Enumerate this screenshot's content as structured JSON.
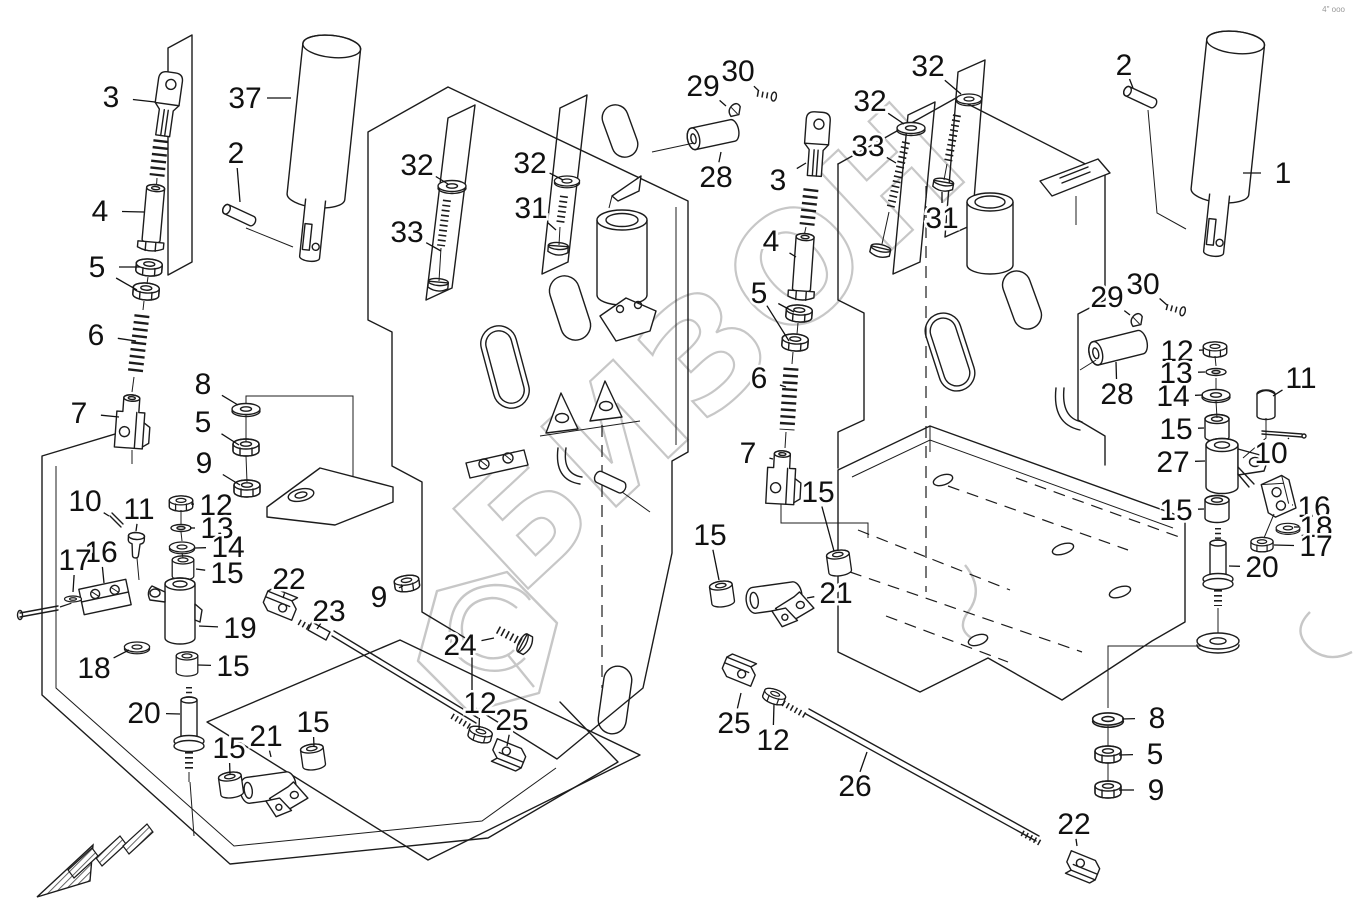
{
  "watermark": {
    "text": "БИЗОН",
    "color": "#c7c7c7",
    "logo": "hexagon-emblem"
  },
  "corner_code": "4\" ooo",
  "icons": {
    "direction_arrow": "hatched-arrow-pointing-lower-left"
  },
  "callouts": [
    {
      "n": "3",
      "x": 111,
      "y": 97,
      "t": [
        [
          155,
          102
        ]
      ]
    },
    {
      "n": "37",
      "x": 245,
      "y": 98,
      "t": [
        [
          291,
          98
        ]
      ]
    },
    {
      "n": "2",
      "x": 236,
      "y": 153,
      "t": [
        [
          240,
          202
        ]
      ]
    },
    {
      "n": "4",
      "x": 100,
      "y": 211,
      "t": [
        [
          144,
          212
        ]
      ]
    },
    {
      "n": "5",
      "x": 97,
      "y": 267,
      "t": [
        [
          140,
          267
        ],
        [
          137,
          290
        ]
      ]
    },
    {
      "n": "32",
      "x": 417,
      "y": 165,
      "t": [
        [
          448,
          184
        ]
      ]
    },
    {
      "n": "33",
      "x": 407,
      "y": 232,
      "t": [
        [
          441,
          251
        ]
      ]
    },
    {
      "n": "32",
      "x": 530,
      "y": 163,
      "t": [
        [
          563,
          180
        ]
      ]
    },
    {
      "n": "31",
      "x": 531,
      "y": 208,
      "t": [
        [
          556,
          230
        ]
      ]
    },
    {
      "n": "6",
      "x": 96,
      "y": 335,
      "t": [
        [
          136,
          341
        ]
      ]
    },
    {
      "n": "7",
      "x": 79,
      "y": 413,
      "t": [
        [
          119,
          417
        ]
      ]
    },
    {
      "n": "8",
      "x": 203,
      "y": 384,
      "t": [
        [
          238,
          405
        ]
      ]
    },
    {
      "n": "5",
      "x": 203,
      "y": 422,
      "t": [
        [
          239,
          445
        ]
      ]
    },
    {
      "n": "9",
      "x": 204,
      "y": 463,
      "t": [
        [
          240,
          485
        ]
      ]
    },
    {
      "n": "10",
      "x": 85,
      "y": 501,
      "t": [
        [
          109,
          516
        ]
      ]
    },
    {
      "n": "11",
      "x": 139,
      "y": 509,
      "t": [
        [
          136,
          531
        ]
      ]
    },
    {
      "n": "12",
      "x": 216,
      "y": 505,
      "t": [
        [
          191,
          504
        ]
      ]
    },
    {
      "n": "13",
      "x": 217,
      "y": 528,
      "t": [
        [
          190,
          528
        ]
      ]
    },
    {
      "n": "14",
      "x": 228,
      "y": 547,
      "t": [
        [
          195,
          548
        ]
      ]
    },
    {
      "n": "15",
      "x": 227,
      "y": 573,
      "t": [
        [
          196,
          569
        ]
      ]
    },
    {
      "n": "16",
      "x": 101,
      "y": 552,
      "t": [
        [
          104,
          583
        ]
      ]
    },
    {
      "n": "17",
      "x": 75,
      "y": 560,
      "t": [
        [
          73,
          592
        ]
      ]
    },
    {
      "n": "19",
      "x": 240,
      "y": 628,
      "t": [
        [
          199,
          626
        ]
      ]
    },
    {
      "n": "18",
      "x": 94,
      "y": 668,
      "t": [
        [
          129,
          650
        ]
      ]
    },
    {
      "n": "15",
      "x": 233,
      "y": 666,
      "t": [
        [
          198,
          665
        ]
      ]
    },
    {
      "n": "20",
      "x": 144,
      "y": 713,
      "t": [
        [
          180,
          714
        ]
      ]
    },
    {
      "n": "15",
      "x": 229,
      "y": 748,
      "t": [
        [
          230,
          774
        ]
      ]
    },
    {
      "n": "21",
      "x": 266,
      "y": 736,
      "t": [
        [
          271,
          757
        ]
      ]
    },
    {
      "n": "15",
      "x": 313,
      "y": 722,
      "t": [
        [
          314,
          747
        ]
      ]
    },
    {
      "n": "22",
      "x": 289,
      "y": 579,
      "t": [
        [
          283,
          598
        ]
      ]
    },
    {
      "n": "23",
      "x": 329,
      "y": 611,
      "t": [
        [
          317,
          629
        ]
      ]
    },
    {
      "n": "9",
      "x": 379,
      "y": 597,
      "t": [
        [
          403,
          586
        ]
      ]
    },
    {
      "n": "24",
      "x": 460,
      "y": 645,
      "t": [
        [
          494,
          638
        ]
      ]
    },
    {
      "n": "12",
      "x": 480,
      "y": 703,
      "t": [
        [
          479,
          730
        ]
      ]
    },
    {
      "n": "25",
      "x": 512,
      "y": 720,
      "t": [
        [
          507,
          746
        ]
      ]
    },
    {
      "n": "29",
      "x": 703,
      "y": 86,
      "t": [
        [
          726,
          106
        ]
      ]
    },
    {
      "n": "30",
      "x": 738,
      "y": 71,
      "t": [
        [
          759,
          91
        ]
      ]
    },
    {
      "n": "28",
      "x": 716,
      "y": 177,
      "t": [
        [
          721,
          152
        ]
      ]
    },
    {
      "n": "3",
      "x": 778,
      "y": 180,
      "t": [
        [
          806,
          163
        ]
      ]
    },
    {
      "n": "4",
      "x": 771,
      "y": 241,
      "t": [
        [
          796,
          257
        ]
      ]
    },
    {
      "n": "5",
      "x": 759,
      "y": 293,
      "t": [
        [
          794,
          312
        ],
        [
          789,
          341
        ]
      ]
    },
    {
      "n": "32",
      "x": 870,
      "y": 101,
      "t": [
        [
          904,
          124
        ]
      ]
    },
    {
      "n": "33",
      "x": 868,
      "y": 146,
      "t": [
        [
          896,
          163
        ]
      ]
    },
    {
      "n": "32",
      "x": 928,
      "y": 66,
      "t": [
        [
          961,
          94
        ]
      ]
    },
    {
      "n": "31",
      "x": 942,
      "y": 218,
      "t": [
        [
          942,
          192
        ]
      ]
    },
    {
      "n": "2",
      "x": 1124,
      "y": 65,
      "t": [
        [
          1133,
          88
        ]
      ]
    },
    {
      "n": "1",
      "x": 1283,
      "y": 173,
      "t": [
        [
          1243,
          173
        ]
      ]
    },
    {
      "n": "29",
      "x": 1107,
      "y": 297,
      "t": [
        [
          1130,
          315
        ]
      ]
    },
    {
      "n": "30",
      "x": 1143,
      "y": 284,
      "t": [
        [
          1167,
          305
        ]
      ]
    },
    {
      "n": "28",
      "x": 1117,
      "y": 394,
      "t": [
        [
          1116,
          362
        ]
      ]
    },
    {
      "n": "12",
      "x": 1177,
      "y": 351,
      "t": [
        [
          1204,
          350
        ]
      ]
    },
    {
      "n": "13",
      "x": 1176,
      "y": 373,
      "t": [
        [
          1205,
          372
        ]
      ]
    },
    {
      "n": "14",
      "x": 1173,
      "y": 396,
      "t": [
        [
          1203,
          395
        ]
      ]
    },
    {
      "n": "15",
      "x": 1176,
      "y": 429,
      "t": [
        [
          1204,
          428
        ]
      ]
    },
    {
      "n": "11",
      "x": 1301,
      "y": 378,
      "t": [
        [
          1273,
          396
        ]
      ]
    },
    {
      "n": "10",
      "x": 1271,
      "y": 453,
      "t": [
        [
          1289,
          438
        ]
      ]
    },
    {
      "n": "27",
      "x": 1173,
      "y": 462,
      "t": [
        [
          1205,
          461
        ]
      ]
    },
    {
      "n": "16",
      "x": 1314,
      "y": 507,
      "t": [
        [
          1293,
          505
        ]
      ]
    },
    {
      "n": "18",
      "x": 1316,
      "y": 527,
      "t": [
        [
          1299,
          527
        ]
      ]
    },
    {
      "n": "17",
      "x": 1316,
      "y": 546,
      "t": [
        [
          1274,
          545
        ]
      ]
    },
    {
      "n": "15",
      "x": 1176,
      "y": 510,
      "t": [
        [
          1204,
          509
        ]
      ]
    },
    {
      "n": "20",
      "x": 1262,
      "y": 567,
      "t": [
        [
          1229,
          566
        ]
      ]
    },
    {
      "n": "6",
      "x": 759,
      "y": 378,
      "t": [
        [
          786,
          387
        ]
      ]
    },
    {
      "n": "7",
      "x": 748,
      "y": 453,
      "t": [
        [
          773,
          459
        ]
      ]
    },
    {
      "n": "15",
      "x": 818,
      "y": 492,
      "t": [
        [
          834,
          551
        ]
      ]
    },
    {
      "n": "15",
      "x": 710,
      "y": 535,
      "t": [
        [
          719,
          580
        ]
      ]
    },
    {
      "n": "21",
      "x": 836,
      "y": 593,
      "t": [
        [
          807,
          598
        ]
      ]
    },
    {
      "n": "25",
      "x": 734,
      "y": 723,
      "t": [
        [
          741,
          693
        ]
      ]
    },
    {
      "n": "12",
      "x": 773,
      "y": 740,
      "t": [
        [
          774,
          704
        ]
      ]
    },
    {
      "n": "26",
      "x": 855,
      "y": 786,
      "t": [
        [
          867,
          752
        ]
      ]
    },
    {
      "n": "8",
      "x": 1157,
      "y": 718,
      "t": [
        [
          1122,
          719
        ]
      ]
    },
    {
      "n": "5",
      "x": 1155,
      "y": 754,
      "t": [
        [
          1119,
          755
        ]
      ]
    },
    {
      "n": "9",
      "x": 1156,
      "y": 790,
      "t": [
        [
          1119,
          790
        ]
      ]
    },
    {
      "n": "22",
      "x": 1074,
      "y": 824,
      "t": [
        [
          1077,
          846
        ]
      ]
    }
  ]
}
